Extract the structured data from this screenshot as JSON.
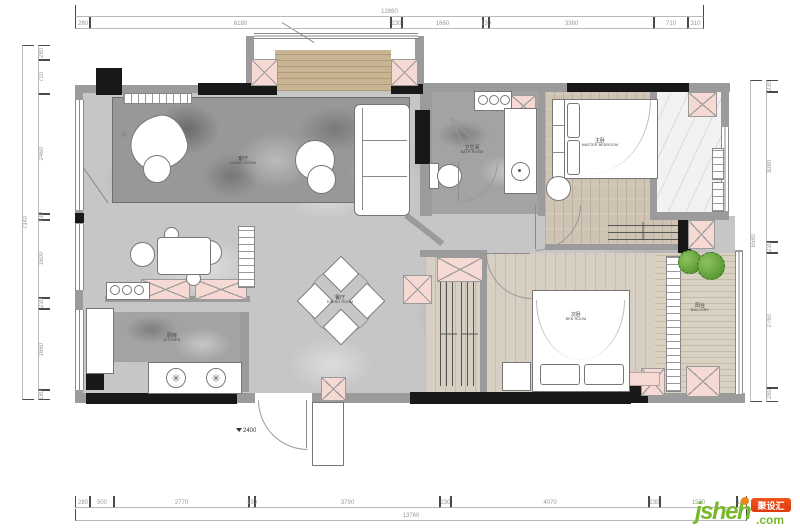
{
  "title": "apartment-floor-plan",
  "dims": {
    "top": {
      "overall": "12860",
      "segments": [
        "280",
        "6180",
        "230",
        "1660",
        "130",
        "3380",
        "710",
        "310"
      ]
    },
    "bottom": {
      "overall": "13760",
      "segments": [
        "280",
        "500",
        "2770",
        "130",
        "3790",
        "230",
        "4070",
        "230",
        "1580",
        "180"
      ]
    },
    "left": {
      "overall": "7340",
      "segments": [
        "280",
        "710",
        "2460",
        "130",
        "1600",
        "230",
        "1660",
        "180"
      ]
    },
    "right": {
      "overall": "6580",
      "segments": [
        "230",
        "3080",
        "230",
        "2760",
        "280"
      ]
    }
  },
  "level_marker": {
    "value": "2400"
  },
  "rooms": {
    "living": {
      "name": "客厅",
      "en": "LIVING ROOM"
    },
    "dining": {
      "name": "餐厅",
      "en": "DINING ROOM"
    },
    "kitchen": {
      "name": "厨房",
      "en": "KITCHEN"
    },
    "bathroom": {
      "name": "卫生间",
      "en": "BATH ROOM"
    },
    "master_bedroom": {
      "name": "主卧",
      "en": "MASTER BEDROOM"
    },
    "bedroom": {
      "name": "次卧",
      "en": "BED ROOM"
    },
    "balcony": {
      "name": "阳台",
      "en": "BALCONY"
    }
  },
  "watermark": {
    "brand": "jsheh",
    "tld": ".com",
    "badge": "聚设汇"
  },
  "colors": {
    "wall": "#9b9b9b",
    "wall_dark": "#181818",
    "column_fill": "#f5d9d2",
    "wood": "#cfc4b4",
    "marble": "#c6c6c6",
    "plant": "#5d9c38",
    "brand_green": "#79b82c",
    "brand_orange": "#f1861d",
    "badge_red": "#dd3a0e"
  }
}
